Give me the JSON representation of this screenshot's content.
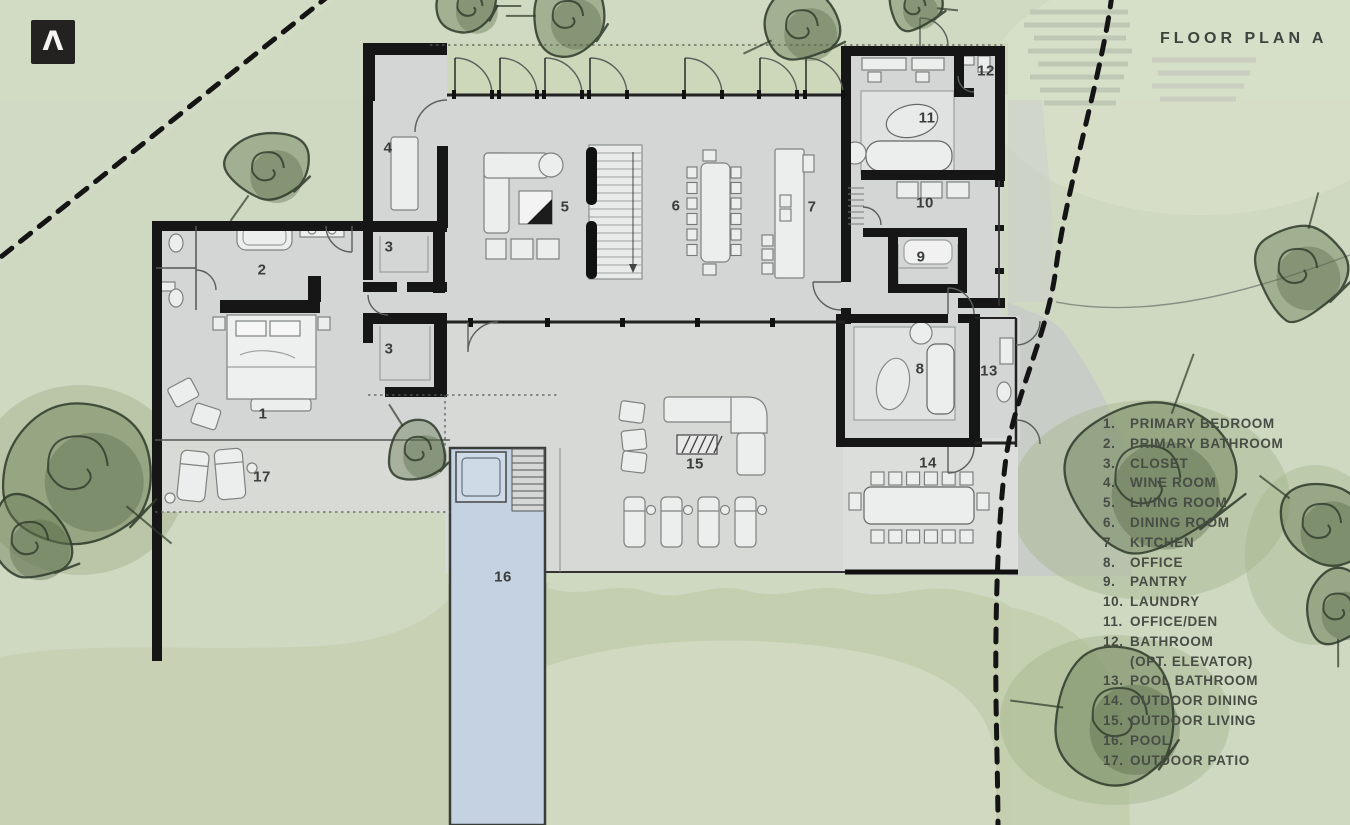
{
  "logo": {
    "glyph": "Λ"
  },
  "header": {
    "title": "FLOOR PLAN A"
  },
  "legend": {
    "items": [
      {
        "num": "1.",
        "label": "PRIMARY BEDROOM"
      },
      {
        "num": "2.",
        "label": "PRIMARY BATHROOM"
      },
      {
        "num": "3.",
        "label": "CLOSET"
      },
      {
        "num": "4.",
        "label": "WINE ROOM"
      },
      {
        "num": "5.",
        "label": "LIVING ROOM"
      },
      {
        "num": "6.",
        "label": "DINING ROOM"
      },
      {
        "num": "7.",
        "label": "KITCHEN"
      },
      {
        "num": "8.",
        "label": "OFFICE"
      },
      {
        "num": "9.",
        "label": "PANTRY"
      },
      {
        "num": "10.",
        "label": "LAUNDRY"
      },
      {
        "num": "11.",
        "label": "OFFICE/DEN"
      },
      {
        "num": "12.",
        "label": "BATHROOM",
        "label2": "(OPT. ELEVATOR)"
      },
      {
        "num": "13.",
        "label": "POOL BATHROOM"
      },
      {
        "num": "14.",
        "label": "OUTDOOR DINING"
      },
      {
        "num": "15.",
        "label": "OUTDOOR LIVING"
      },
      {
        "num": "16.",
        "label": "POOL"
      },
      {
        "num": "17.",
        "label": "OUTDOOR PATIO"
      }
    ]
  },
  "plan": {
    "labels": {
      "primary_bedroom": "1",
      "primary_bathroom": "2",
      "closet_upper": "3",
      "closet_lower": "3",
      "wine_room": "4",
      "living_room": "5",
      "dining_room": "6",
      "kitchen": "7",
      "office": "8",
      "pantry": "9",
      "laundry": "10",
      "office_den": "11",
      "bathroom_elevator": "12",
      "pool_bathroom": "13",
      "outdoor_dining": "14",
      "outdoor_living": "15",
      "pool": "16",
      "outdoor_patio": "17"
    }
  },
  "colors": {
    "background_green": "#cfd8c1",
    "plan_gray": "#d3d6d4",
    "pool_blue": "#c4d2e1",
    "tree_green": "#64794f",
    "wall_black": "#161616"
  }
}
